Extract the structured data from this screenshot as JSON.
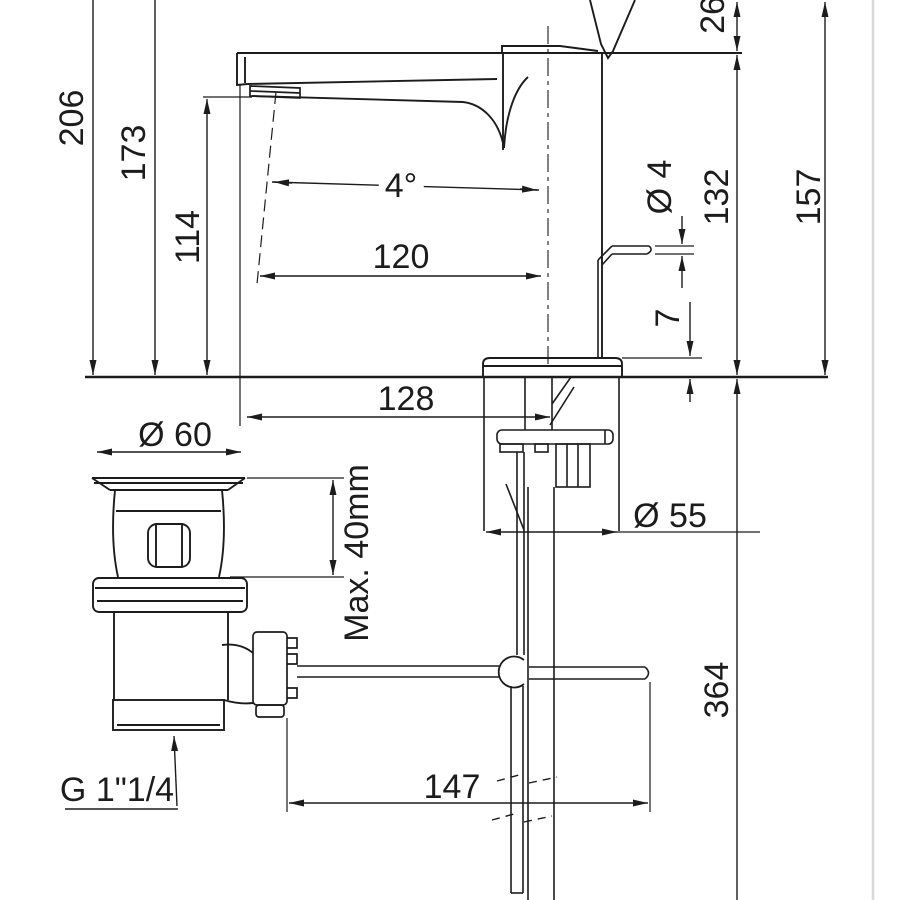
{
  "drawing": {
    "title": "basin mixer faucet technical drawing",
    "view": "side elevation with pop-up waste drain and dimensions",
    "units": "mm",
    "line_color": "#1c1c1c",
    "page_edge_color": "#d9d9d9",
    "background": "#ffffff"
  },
  "dimensions": {
    "overall_height": "206",
    "height_to_spout_tip": "173",
    "spout_outlet_height": "114",
    "handle_top_offset": "26",
    "body_height": "157",
    "spout_line_to_deck": "132",
    "pull_rod_diameter": "Ø 4",
    "base_plate_thickness": "7",
    "spout_angle": "4°",
    "spout_reach": "120",
    "tip_to_axis": "128",
    "drain_flange_diameter": "Ø 60",
    "max_deck_thickness": "Max. 40mm",
    "base_diameter": "Ø 55",
    "rod_length": "147",
    "pipe_length": "364",
    "drain_thread": "G 1\"1/4"
  }
}
